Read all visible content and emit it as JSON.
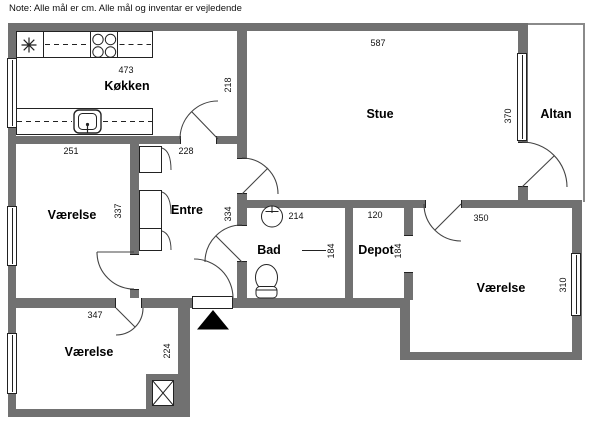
{
  "note": "Note: Alle mål er cm. Alle mål og inventar er vejledende",
  "colors": {
    "wall": "#717171",
    "line": "#222222",
    "arc": "#444444",
    "text": "#000000",
    "entrance_marker": "#000000"
  },
  "rooms": {
    "kokken": {
      "label": "Køkken",
      "width": "473",
      "height": "218"
    },
    "stue": {
      "label": "Stue",
      "width": "587",
      "height": "370"
    },
    "altan": {
      "label": "Altan"
    },
    "vaerelse1": {
      "label": "Værelse",
      "width": "251",
      "height": "337"
    },
    "entre": {
      "label": "Entre",
      "width": "228",
      "height": "334"
    },
    "bad": {
      "label": "Bad",
      "width": "214",
      "height": "184"
    },
    "depot": {
      "label": "Depot",
      "width": "120",
      "height": "184"
    },
    "vaerelse2": {
      "label": "Værelse",
      "width": "350",
      "height": "310"
    },
    "vaerelse3": {
      "label": "Værelse",
      "width": "347",
      "height": "224"
    }
  },
  "symbols": {
    "kitchen": [
      "cooktop-light-icon",
      "stove-burners-icon",
      "kitchen-sink-icon",
      "counter"
    ],
    "bathroom": [
      "washbasin-icon",
      "toilet-icon"
    ],
    "other": [
      "duct-shaft-icon",
      "entrance-arrow-icon",
      "window",
      "door-swing",
      "closet"
    ]
  }
}
